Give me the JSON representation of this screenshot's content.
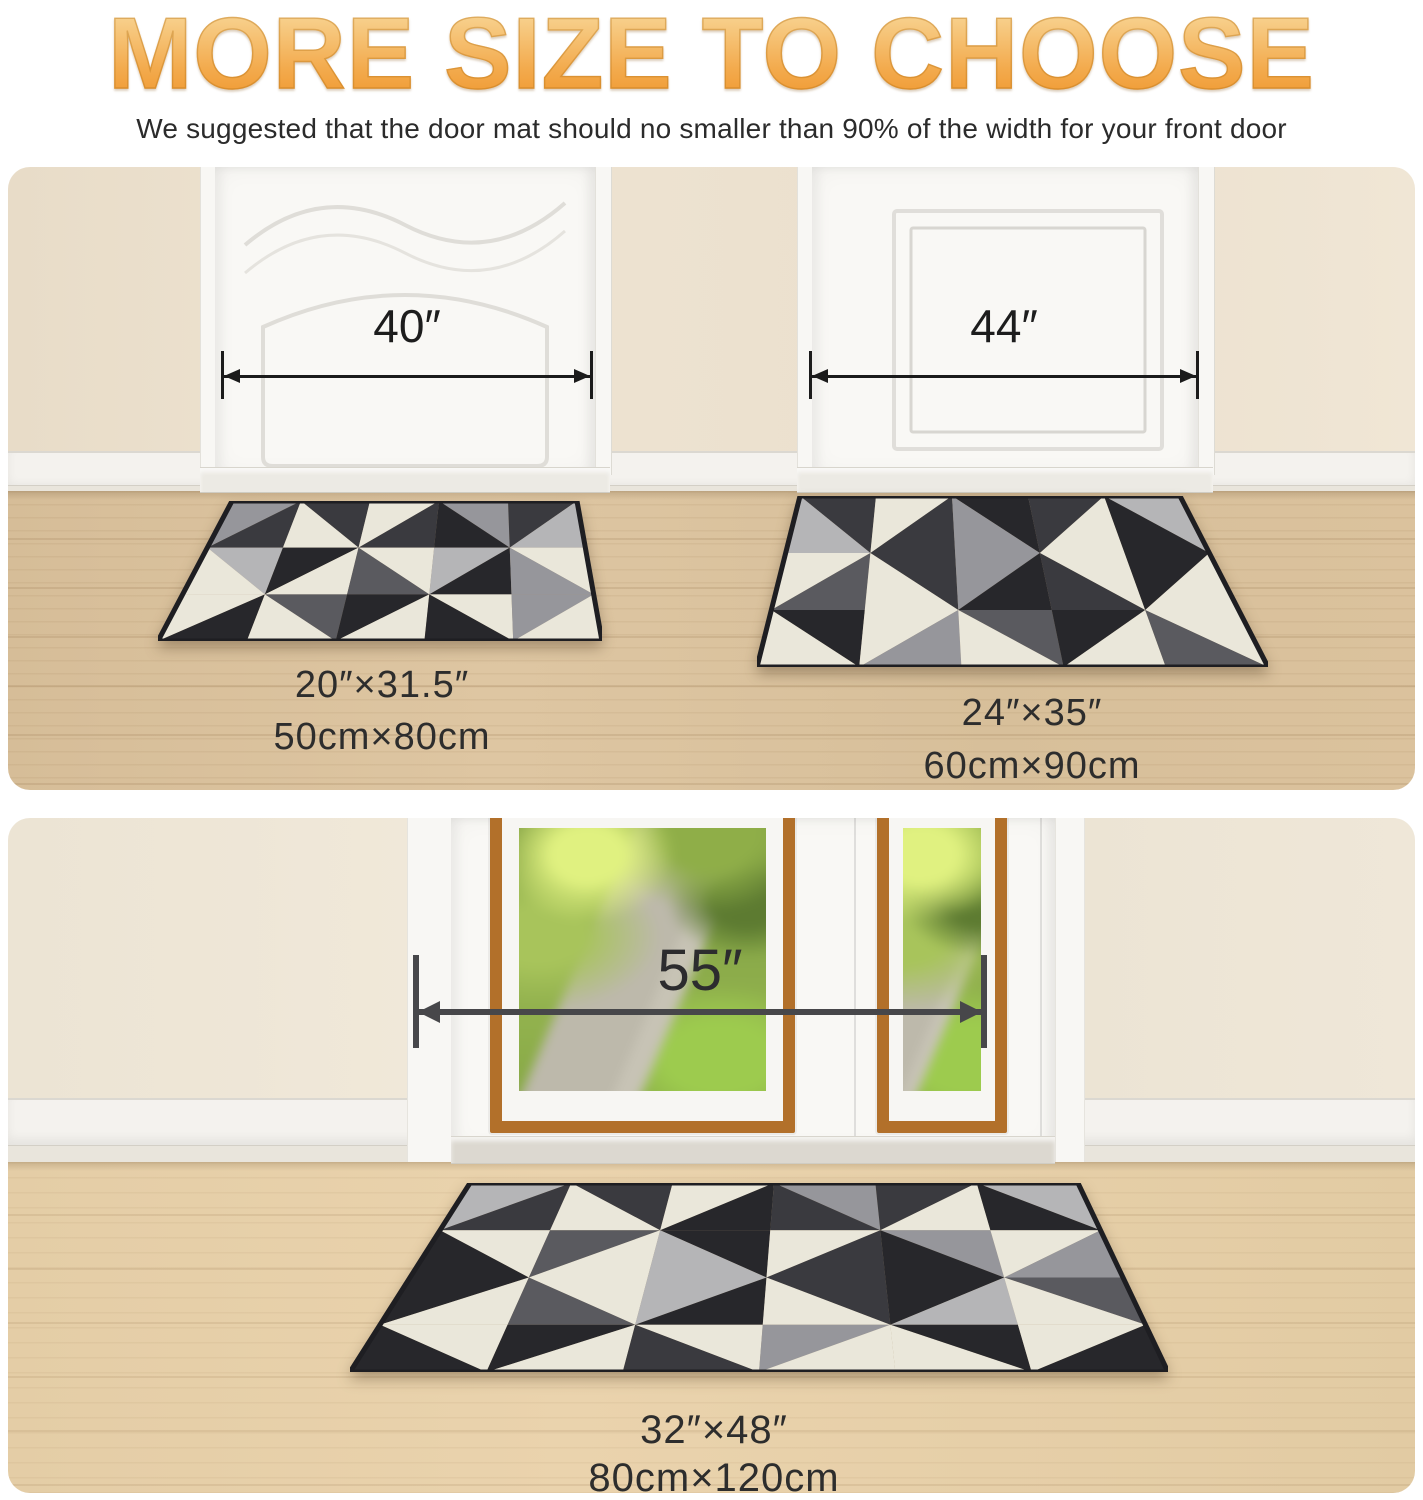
{
  "title": "MORE SIZE TO CHOOSE",
  "subtitle": "We suggested that the door mat should no smaller than 90% of the width for your front door",
  "colors": {
    "title_gradient_top": "#f8d89e",
    "title_gradient_bottom": "#ee9226",
    "dimension_arrow_small": "#1b1b1b",
    "dimension_arrow_large": "#47474a",
    "label_text": "#2d2d2d",
    "wall_beige": "#ebdfcd",
    "floor_wood_top": "#d9c09b",
    "floor_wood_bottom": "#e6cfa9",
    "door_white": "#f8f7f4",
    "window_trim_orange": "#b2702a"
  },
  "scene_top": {
    "door_left_width": "40″",
    "door_right_width": "44″",
    "mat_small": {
      "inches": "20″×31.5″",
      "cm": "50cm×80cm"
    },
    "mat_medium": {
      "inches": "24″×35″",
      "cm": "60cm×90cm"
    }
  },
  "scene_bottom": {
    "door_width": "55″",
    "mat_large": {
      "inches": "32″×48″",
      "cm": "80cm×120cm"
    }
  },
  "mats": {
    "palette": {
      "ch": "#3a3a3f",
      "bk": "#27272b",
      "cr": "#eae7da",
      "mg": "#96969b",
      "sg": "#b5b5b7",
      "dg": "#5a5a5f"
    },
    "border_color": "#1e1e22",
    "items": [
      {
        "name": "mat-small",
        "cols": 5,
        "rows": 3,
        "corners": [
          [
            224,
            334
          ],
          [
            569,
            334
          ],
          [
            594,
            474
          ],
          [
            150,
            474
          ]
        ],
        "cells": [
          [
            1,
            "mg",
            "ch"
          ],
          [
            0,
            "ch",
            "cr"
          ],
          [
            1,
            "cr",
            "ch"
          ],
          [
            0,
            "mg",
            "bk"
          ],
          [
            1,
            "ch",
            "sg"
          ],
          [
            0,
            "sg",
            "cr"
          ],
          [
            1,
            "bk",
            "cr"
          ],
          [
            0,
            "cr",
            "dg"
          ],
          [
            1,
            "sg",
            "bk"
          ],
          [
            0,
            "cr",
            "mg"
          ],
          [
            1,
            "cr",
            "bk"
          ],
          [
            0,
            "dg",
            "cr"
          ],
          [
            1,
            "bk",
            "cr"
          ],
          [
            0,
            "cr",
            "bk"
          ],
          [
            1,
            "mg",
            "cr"
          ]
        ]
      },
      {
        "name": "mat-medium",
        "cols": 5,
        "rows": 3,
        "corners": [
          [
            792,
            329
          ],
          [
            1172,
            329
          ],
          [
            1260,
            500
          ],
          [
            749,
            500
          ]
        ],
        "cells": [
          [
            0,
            "ch",
            "sg"
          ],
          [
            1,
            "cr",
            "ch"
          ],
          [
            0,
            "bk",
            "mg"
          ],
          [
            1,
            "ch",
            "cr"
          ],
          [
            0,
            "sg",
            "bk"
          ],
          [
            1,
            "cr",
            "dg"
          ],
          [
            0,
            "ch",
            "cr"
          ],
          [
            1,
            "mg",
            "bk"
          ],
          [
            0,
            "cr",
            "ch"
          ],
          [
            1,
            "bk",
            "cr"
          ],
          [
            0,
            "bk",
            "cr"
          ],
          [
            1,
            "cr",
            "mg"
          ],
          [
            0,
            "dg",
            "cr"
          ],
          [
            1,
            "bk",
            "cr"
          ],
          [
            0,
            "cr",
            "dg"
          ]
        ]
      },
      {
        "name": "mat-large",
        "cols": 6,
        "rows": 4,
        "corners": [
          [
            462,
            365
          ],
          [
            1070,
            365
          ],
          [
            1160,
            554
          ],
          [
            342,
            554
          ]
        ],
        "cells": [
          [
            1,
            "sg",
            "ch"
          ],
          [
            0,
            "ch",
            "cr"
          ],
          [
            1,
            "cr",
            "bk"
          ],
          [
            0,
            "mg",
            "ch"
          ],
          [
            1,
            "ch",
            "cr"
          ],
          [
            0,
            "sg",
            "bk"
          ],
          [
            0,
            "cr",
            "bk"
          ],
          [
            1,
            "dg",
            "cr"
          ],
          [
            0,
            "bk",
            "sg"
          ],
          [
            1,
            "cr",
            "ch"
          ],
          [
            0,
            "mg",
            "bk"
          ],
          [
            1,
            "cr",
            "mg"
          ],
          [
            1,
            "bk",
            "cr"
          ],
          [
            0,
            "cr",
            "dg"
          ],
          [
            1,
            "sg",
            "bk"
          ],
          [
            0,
            "ch",
            "cr"
          ],
          [
            1,
            "bk",
            "sg"
          ],
          [
            0,
            "dg",
            "cr"
          ],
          [
            0,
            "cr",
            "bk"
          ],
          [
            1,
            "bk",
            "cr"
          ],
          [
            0,
            "cr",
            "ch"
          ],
          [
            1,
            "mg",
            "cr"
          ],
          [
            0,
            "bk",
            "cr"
          ],
          [
            1,
            "cr",
            "bk"
          ]
        ]
      }
    ]
  }
}
